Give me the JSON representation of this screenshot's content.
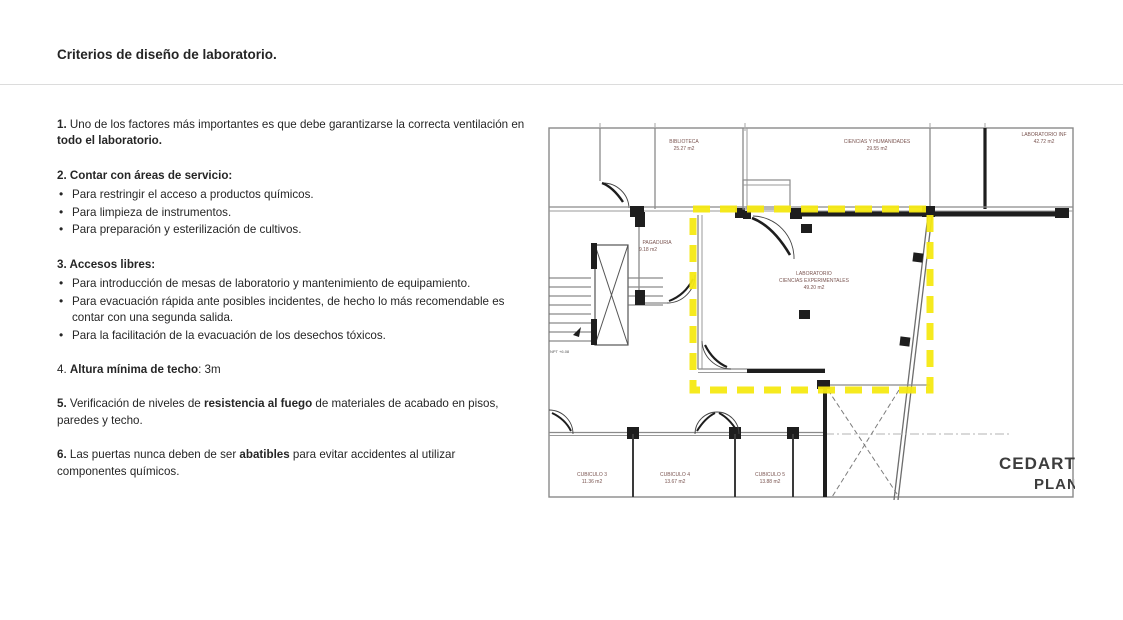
{
  "page": {
    "title": "Criterios de diseño de laboratorio."
  },
  "content": {
    "sections": [
      {
        "runs": [
          {
            "t": "1.",
            "b": true
          },
          {
            "t": " Uno de los factores más importantes es que debe garantizarse la correcta ventilación en ",
            "b": false
          },
          {
            "t": "todo el laboratorio.",
            "b": true
          }
        ]
      },
      {
        "heading": [
          {
            "t": "2. Contar con áreas de servicio:",
            "b": true
          }
        ],
        "items": [
          [
            {
              "t": "Para restringir el acceso a productos químicos.",
              "b": false
            }
          ],
          [
            {
              "t": "Para limpieza de instrumentos.",
              "b": false
            }
          ],
          [
            {
              "t": "Para preparación y esterilización de cultivos.",
              "b": false
            }
          ]
        ]
      },
      {
        "heading": [
          {
            "t": "3. Accesos libres:",
            "b": true
          }
        ],
        "items": [
          [
            {
              "t": "Para introducción de mesas de laboratorio y mantenimiento de equipamiento.",
              "b": false
            }
          ],
          [
            {
              "t": "Para evacuación rápida ante posibles incidentes, de hecho lo más recomendable es contar con una segunda salida.",
              "b": false
            }
          ],
          [
            {
              "t": "Para la facilitación de la evacuación de los desechos tóxicos.",
              "b": false
            }
          ]
        ]
      },
      {
        "runs": [
          {
            "t": "4. ",
            "b": false
          },
          {
            "t": "Altura mínima de techo",
            "b": true
          },
          {
            "t": ": 3m",
            "b": false
          }
        ]
      },
      {
        "runs": [
          {
            "t": "5.",
            "b": true
          },
          {
            "t": " Verificación de niveles de ",
            "b": false
          },
          {
            "t": "resistencia al fuego",
            "b": true
          },
          {
            "t": " de materiales de acabado en pisos, paredes y techo.",
            "b": false
          }
        ]
      },
      {
        "runs": [
          {
            "t": "6.",
            "b": true
          },
          {
            "t": " Las puertas nunca deben de ser ",
            "b": false
          },
          {
            "t": "abatibles",
            "b": true
          },
          {
            "t": " para evitar accidentes al utilizar componentes químicos.",
            "b": false
          }
        ]
      }
    ]
  },
  "floorplan": {
    "highlight_color": "#F6E912",
    "rooms": [
      {
        "name": "BIBLIOTECA",
        "area": "25.27 m2"
      },
      {
        "name": "CIENCIAS Y HUMANIDADES",
        "area": "29.55 m2"
      },
      {
        "name": "LABORATORIO INF",
        "area": "42.72 m2"
      },
      {
        "name": "PAGADURIA",
        "area": "9.18 m2"
      },
      {
        "name": "LABORATORIO",
        "name2": "CIENCIAS EXPERIMENTALES",
        "area": "49.20 m2"
      },
      {
        "name": "CUBICULO 3",
        "area": "11.36 m2"
      },
      {
        "name": "CUBICULO 4",
        "area": "13.67 m2"
      },
      {
        "name": "CUBICULO 5",
        "area": "13.88 m2"
      }
    ],
    "level_label": "NPT +6.08",
    "watermark": {
      "line1": "CEDART",
      "line2": "PLAN"
    }
  }
}
